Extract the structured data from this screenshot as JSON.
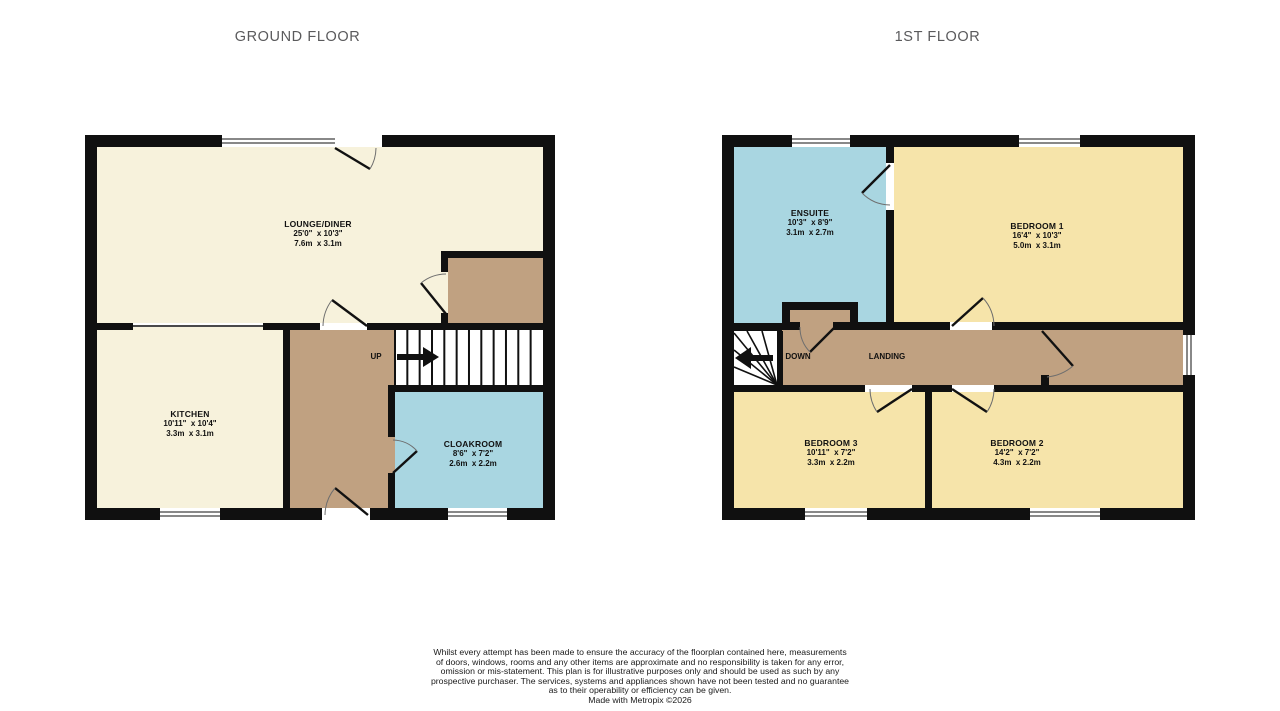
{
  "titles": {
    "ground": "GROUND FLOOR",
    "first": "1ST FLOOR"
  },
  "ground_floor": {
    "lounge": {
      "name": "LOUNGE/DINER",
      "imperial": "25'0\"  x 10'3\"",
      "metric": "7.6m  x 3.1m"
    },
    "kitchen": {
      "name": "KITCHEN",
      "imperial": "10'11\"  x 10'4\"",
      "metric": "3.3m  x 3.1m"
    },
    "cloakroom": {
      "name": "CLOAKROOM",
      "imperial": "8'6\"  x 7'2\"",
      "metric": "2.6m  x 2.2m"
    },
    "stairs_label": "UP"
  },
  "first_floor": {
    "ensuite": {
      "name": "ENSUITE",
      "imperial": "10'3\"  x 8'9\"",
      "metric": "3.1m  x 2.7m"
    },
    "bedroom1": {
      "name": "BEDROOM 1",
      "imperial": "16'4\"  x 10'3\"",
      "metric": "5.0m  x 3.1m"
    },
    "bedroom3": {
      "name": "BEDROOM 3",
      "imperial": "10'11\"  x 7'2\"",
      "metric": "3.3m  x 2.2m"
    },
    "bedroom2": {
      "name": "BEDROOM 2",
      "imperial": "14'2\"  x 7'2\"",
      "metric": "4.3m  x 2.2m"
    },
    "landing_label": "LANDING",
    "stairs_label": "DOWN"
  },
  "footer": {
    "lines": [
      "Whilst every attempt has been made to ensure the accuracy of the floorplan contained here, measurements",
      "of doors, windows, rooms and any other items are approximate and no responsibility is taken for any error,",
      "omission or mis-statement. This plan is for illustrative purposes only and should be used as such by any",
      "prospective purchaser. The services, systems and appliances shown have not been tested and no guarantee",
      "as to their operability or efficiency can be given.",
      "Made with Metropix ©2026"
    ]
  },
  "colors": {
    "wall": "#101010",
    "lounge_kitchen_cream": "#f7f2dc",
    "bedroom_yellow": "#f6e4aa",
    "wet_room_blue": "#a9d6e1",
    "hall_landing_brown": "#c0a181",
    "title_gray": "#5a5a5c",
    "background": "#ffffff"
  }
}
